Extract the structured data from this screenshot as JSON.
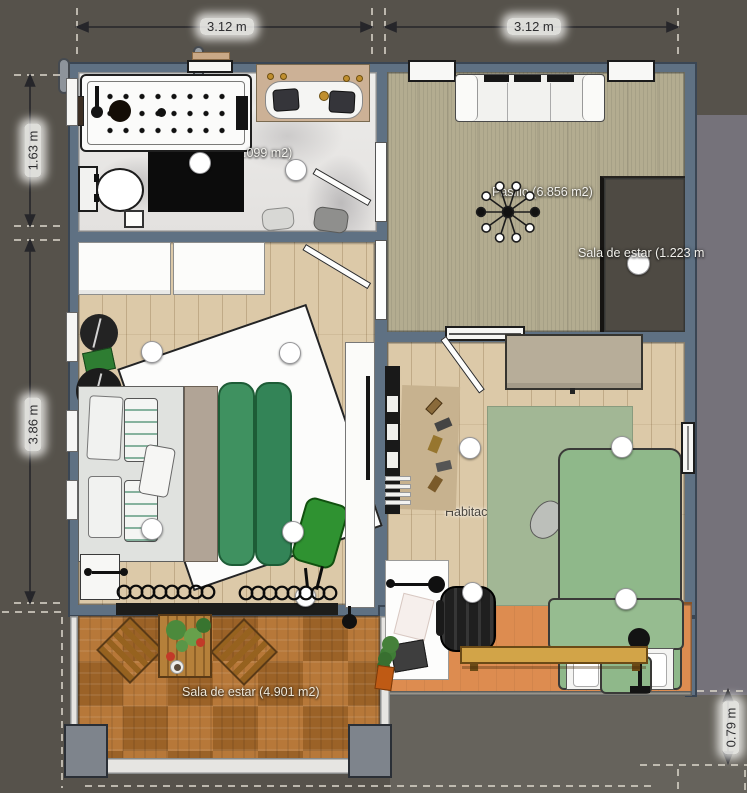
{
  "dimension_labels": [
    {
      "id": "top-left",
      "label": "3.12 m"
    },
    {
      "id": "top-right",
      "label": "3.12 m"
    },
    {
      "id": "left-upper",
      "label": "1.63 m"
    },
    {
      "id": "left-lower",
      "label": "3.86 m"
    },
    {
      "id": "bottom-right",
      "label": "0.79 m"
    }
  ],
  "room_labels": {
    "bathroom": ".099 m2)",
    "pasillo": "Pasillo (6.856 m2)",
    "sala_de_estar_right": "Sala de estar (1.223 m",
    "habitacion": "Habitac",
    "sala_de_estar_terrace": "Sala de estar (4.901 m2)"
  },
  "colors": {
    "exterior_ground": "#56524b",
    "exterior_ground_right": "#75727a",
    "exterior_ground_bottom": "#66635c",
    "wall": "#5f7183",
    "marble_floor": "#eceae8",
    "carpet_floor": "#b3ac90",
    "wood_floor": "#dcc9a8",
    "dark_room_floor": "#4e4a43",
    "terrace_parquet": "#b2702d",
    "balcony_floor": "#dd8c50",
    "bed_duvet_green": "#3f9160",
    "bed_green": "#8fb88a",
    "rug_green": "#a2b795",
    "accent_chair_green": "#2f9231"
  }
}
